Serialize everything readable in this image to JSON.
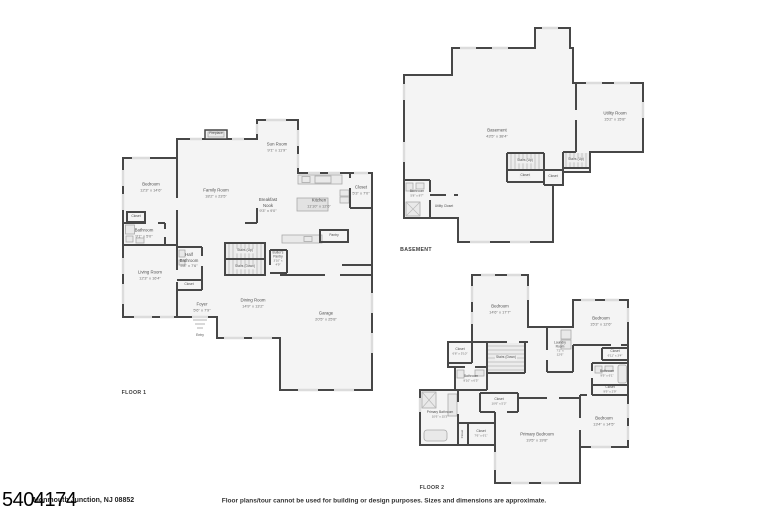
{
  "page": {
    "listing_id": "5404174",
    "address": "Monmouth Junction, NJ 08852",
    "disclaimer": "Floor plans/tour cannot be used for building or design purposes. Sizes and dimensions are approximate."
  },
  "floor1": {
    "title": "FLOOR 1",
    "rooms": {
      "fireplace": {
        "name": "Fireplace"
      },
      "sun_room": {
        "name": "Sun Room",
        "dims": "9'1\" x 11'9\""
      },
      "bedroom": {
        "name": "Bedroom",
        "dims": "12'3\" x 14'6\""
      },
      "family_room": {
        "name": "Family Room",
        "dims": "18'2\" x 23'5\""
      },
      "breakfast_nook": {
        "name": "Breakfast Nook",
        "dims": "9'3\" x 9'0\""
      },
      "kitchen": {
        "name": "Kitchen",
        "dims": "11'10\" x 12'6\""
      },
      "closet_kitchen": {
        "name": "Closet",
        "dims": "5'3\" x 7'0\""
      },
      "closet_small": {
        "name": "Closet"
      },
      "bathroom": {
        "name": "Bathroom",
        "dims": "9'1\" x 5'0\""
      },
      "living_room": {
        "name": "Living Room",
        "dims": "12'3\" x 16'4\""
      },
      "half_bathroom": {
        "name": "Half Bathroom",
        "dims": "5'8\" x 7'6\""
      },
      "closet_half_bath": {
        "name": "Closet"
      },
      "stairs_up": {
        "name": "Stairs (Up)"
      },
      "stairs_down": {
        "name": "Stairs (Down)"
      },
      "butlers_pantry": {
        "name": "Butler's Pantry",
        "dims": "3'10\" x 4'9\""
      },
      "pantry": {
        "name": "Pantry"
      },
      "foyer": {
        "name": "Foyer",
        "dims": "5'6\" x 7'9\""
      },
      "entry": {
        "name": "Entry"
      },
      "dining_room": {
        "name": "Dining Room",
        "dims": "14'9\" x 13'2\""
      },
      "garage": {
        "name": "Garage",
        "dims": "20'5\" x 25'8\""
      }
    }
  },
  "basement": {
    "title": "BASEMENT",
    "rooms": {
      "basement": {
        "name": "Basement",
        "dims": "43'5\" x 38'4\""
      },
      "utility_room": {
        "name": "Utility Room",
        "dims": "15'2\" x 15'8\""
      },
      "stairs_up_center": {
        "name": "Stairs (Up)"
      },
      "closet_center": {
        "name": "Closet"
      },
      "closet_2": {
        "name": "Closet"
      },
      "stairs_up_right": {
        "name": "Stairs (Up)"
      },
      "bathroom": {
        "name": "Bathroom",
        "dims": "5'8\" x 8'7\""
      },
      "utility_closet": {
        "name": "Utility Closet"
      }
    }
  },
  "floor2": {
    "title": "FLOOR 2",
    "rooms": {
      "bedroom_1": {
        "name": "Bedroom",
        "dims": "14'6\" x 17'7\""
      },
      "bedroom_2": {
        "name": "Bedroom",
        "dims": "15'3\" x 12'6\""
      },
      "closet_left": {
        "name": "Closet",
        "dims": "6'8\" x 5'10\""
      },
      "stairs_down": {
        "name": "Stairs (Down)"
      },
      "laundry_room": {
        "name": "Laundry Room",
        "dims": "7'2\" x 12'6\""
      },
      "closet_right": {
        "name": "Closet",
        "dims": "6'11\" x 3'4\""
      },
      "bathroom_right": {
        "name": "Bathroom",
        "dims": "9'9\" x 6'1\""
      },
      "closet_right_2": {
        "name": "Closet",
        "dims": "9'9\" x 2'9\""
      },
      "bathroom_left": {
        "name": "Bathroom",
        "dims": "8'10\" x 6'5\""
      },
      "primary_bathroom": {
        "name": "Primary Bathroom",
        "dims": "10'6\" x 15'3\""
      },
      "closet_linen": {
        "name": "Closet"
      },
      "closet_b": {
        "name": "Closet",
        "dims": "7'6\" x 6'1\""
      },
      "closet_center": {
        "name": "Closet",
        "dims": "10'6\" x 5'3\""
      },
      "primary_bedroom": {
        "name": "Primary Bedroom",
        "dims": "19'5\" x 19'8\""
      },
      "bedroom_3": {
        "name": "Bedroom",
        "dims": "13'4\" x 14'5\""
      }
    }
  }
}
